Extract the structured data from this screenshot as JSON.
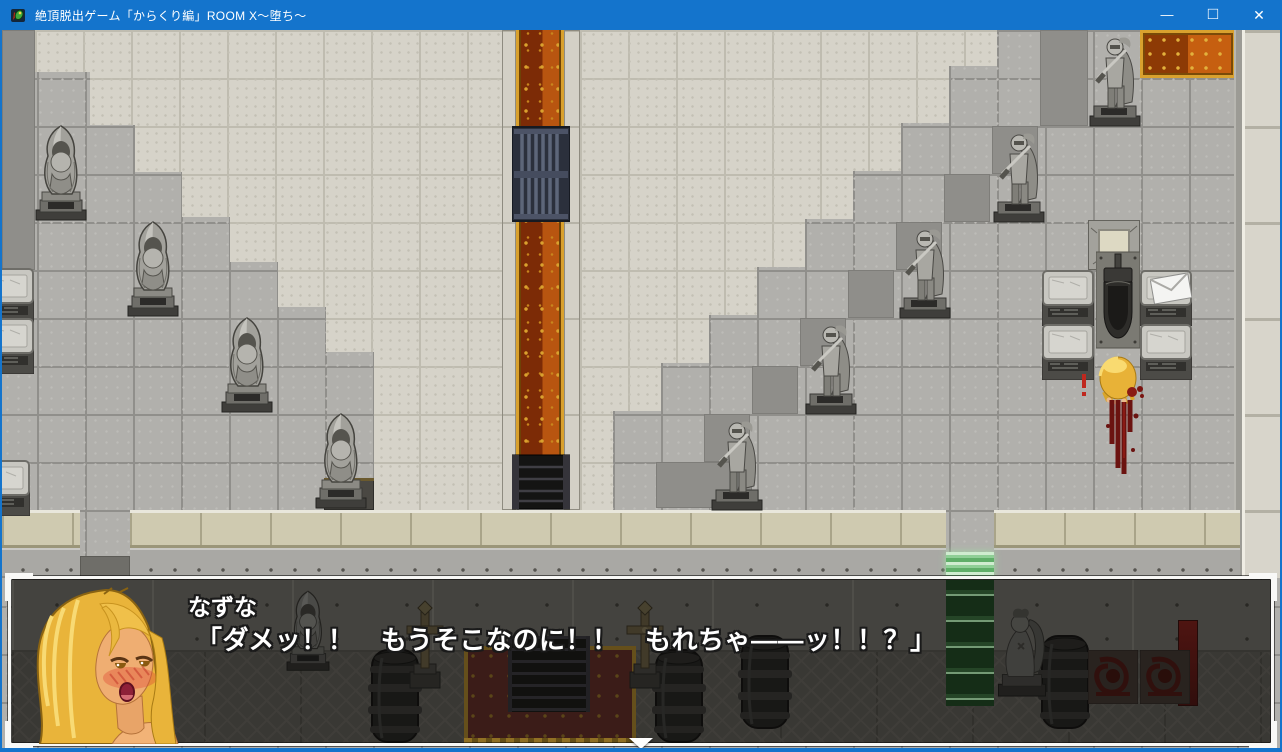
{
  "window": {
    "title": "絶頂脱出ゲーム「からくり編」ROOM X～堕ち～",
    "controls": {
      "minimize": "—",
      "maximize": "□",
      "close": "✕"
    },
    "titlebar_color": "#1474cc"
  },
  "dialogue": {
    "speaker": "なずな",
    "text": "「ダメッ！！　もうそこなのに！！　もれちゃ――ッ！！？」"
  },
  "colors": {
    "floor": "#b1b0ac",
    "platform": "#d6d3c9",
    "carpet_dark": "#7c2b06",
    "carpet_bright": "#b85510",
    "carpet_gold": "#d9a12e",
    "glow_green": "#9fd6a2",
    "blood": "#6b1310",
    "dialog_border": "#f8f8f6"
  },
  "scene": {
    "rects": [
      {
        "cls": "shadow",
        "name": "shadow-tiles",
        "x": 0,
        "y": 0,
        "w": 33,
        "h": 240
      },
      {
        "cls": "shadow",
        "name": "shadow-tiles",
        "x": 1038,
        "y": 0,
        "w": 48,
        "h": 96
      },
      {
        "cls": "shadow",
        "name": "shadow-tiles",
        "x": 990,
        "y": 96,
        "w": 46,
        "h": 48
      },
      {
        "cls": "shadow",
        "name": "shadow-tiles",
        "x": 942,
        "y": 144,
        "w": 46,
        "h": 48
      },
      {
        "cls": "shadow",
        "name": "shadow-tiles",
        "x": 894,
        "y": 192,
        "w": 46,
        "h": 48
      },
      {
        "cls": "shadow",
        "name": "shadow-tiles",
        "x": 846,
        "y": 240,
        "w": 46,
        "h": 48
      },
      {
        "cls": "shadow",
        "name": "shadow-tiles",
        "x": 798,
        "y": 288,
        "w": 46,
        "h": 48
      },
      {
        "cls": "shadow",
        "name": "shadow-tiles",
        "x": 750,
        "y": 336,
        "w": 46,
        "h": 48
      },
      {
        "cls": "shadow",
        "name": "shadow-tiles",
        "x": 702,
        "y": 384,
        "w": 46,
        "h": 48
      },
      {
        "cls": "shadow",
        "name": "shadow-tiles",
        "x": 654,
        "y": 432,
        "w": 96,
        "h": 46
      },
      {
        "cls": "cor-border",
        "name": "corridor-border",
        "x": 500,
        "y": 0,
        "w": 14,
        "h": 480
      },
      {
        "cls": "carpet-v",
        "name": "red-carpet-corridor",
        "x": 514,
        "y": 0,
        "w": 48,
        "h": 478
      },
      {
        "cls": "cor-border",
        "name": "corridor-border",
        "x": 562,
        "y": 0,
        "w": 16,
        "h": 480
      },
      {
        "cls": "carpet-h",
        "name": "red-carpet-top-right",
        "x": 1138,
        "y": 0,
        "w": 96,
        "h": 48
      },
      {
        "cls": "wallcol-edge",
        "name": "right-wall-edge",
        "x": 1232,
        "y": 0,
        "w": 8,
        "h": 548
      },
      {
        "cls": "wallcol",
        "name": "right-wall-column",
        "x": 1240,
        "y": 0,
        "w": 42,
        "h": 548
      },
      {
        "cls": "ledge",
        "name": "bottom-wall-ledge",
        "x": 0,
        "y": 480,
        "w": 78,
        "h": 38
      },
      {
        "cls": "ledge",
        "name": "bottom-wall-ledge",
        "x": 128,
        "y": 480,
        "w": 816,
        "h": 38
      },
      {
        "cls": "ledge",
        "name": "bottom-wall-ledge",
        "x": 992,
        "y": 480,
        "w": 246,
        "h": 38
      },
      {
        "cls": "wallface",
        "name": "bottom-wall-face",
        "x": 0,
        "y": 518,
        "w": 78,
        "h": 30
      },
      {
        "cls": "wallface",
        "name": "bottom-wall-face",
        "x": 128,
        "y": 518,
        "w": 816,
        "h": 30
      },
      {
        "cls": "wallface",
        "name": "bottom-wall-face",
        "x": 992,
        "y": 518,
        "w": 246,
        "h": 30
      },
      {
        "cls": "doorway",
        "name": "doorway-left",
        "x": 78,
        "y": 526,
        "w": 50,
        "h": 22
      },
      {
        "cls": "greendoor",
        "name": "glowing-green-door",
        "x": 944,
        "y": 522,
        "w": 48,
        "h": 26
      },
      {
        "cls": "darkblock",
        "name": "altar-top",
        "x": 322,
        "y": 448,
        "w": 50,
        "h": 32
      },
      {
        "cls": "metalband",
        "name": "metal-wall-band",
        "layer": "dim",
        "x": 10,
        "y": 550,
        "w": 1262,
        "h": 72
      },
      {
        "cls": "green-glow",
        "name": "green-glow-column",
        "layer": "dim",
        "x": 944,
        "y": 550,
        "w": 48,
        "h": 126
      },
      {
        "cls": "carpet-dim",
        "name": "lower-hall-carpet",
        "layer": "dim",
        "x": 462,
        "y": 616,
        "w": 172,
        "h": 98
      },
      {
        "cls": "stairwell",
        "name": "stairwell-down",
        "layer": "dim",
        "x": 506,
        "y": 606,
        "w": 82,
        "h": 76
      },
      {
        "cls": "banner",
        "name": "red-banner",
        "layer": "dim",
        "x": 1176,
        "y": 590,
        "w": 20,
        "h": 86
      },
      {
        "cls": "goldstrip",
        "name": "carpet-gold-trim",
        "layer": "dim",
        "x": 462,
        "y": 708,
        "w": 172,
        "h": 6
      }
    ],
    "objects": [
      {
        "sym": "monk",
        "name": "monk-statue",
        "x": 28,
        "y": 92,
        "w": 62,
        "h": 100
      },
      {
        "sym": "monk",
        "name": "monk-statue",
        "x": 120,
        "y": 188,
        "w": 62,
        "h": 100
      },
      {
        "sym": "monk",
        "name": "monk-statue",
        "x": 214,
        "y": 284,
        "w": 62,
        "h": 100
      },
      {
        "sym": "monk",
        "name": "monk-statue",
        "x": 308,
        "y": 380,
        "w": 62,
        "h": 100
      },
      {
        "sym": "knight",
        "name": "knight-statue",
        "x": 1084,
        "y": 0,
        "w": 58,
        "h": 98
      },
      {
        "sym": "knight",
        "name": "knight-statue",
        "x": 988,
        "y": 96,
        "w": 58,
        "h": 98
      },
      {
        "sym": "knight",
        "name": "knight-statue",
        "x": 894,
        "y": 192,
        "w": 58,
        "h": 98
      },
      {
        "sym": "knight",
        "name": "knight-statue",
        "x": 800,
        "y": 288,
        "w": 58,
        "h": 98
      },
      {
        "sym": "knight",
        "name": "knight-statue",
        "x": 706,
        "y": 384,
        "w": 58,
        "h": 98
      },
      {
        "sym": "pedestal",
        "name": "stone-pedestal",
        "x": -20,
        "y": 238,
        "w": 52,
        "h": 56
      },
      {
        "sym": "pedestal",
        "name": "stone-pedestal",
        "x": -20,
        "y": 288,
        "w": 52,
        "h": 56
      },
      {
        "sym": "pedestal",
        "name": "stone-pedestal",
        "x": -24,
        "y": 430,
        "w": 52,
        "h": 56
      },
      {
        "sym": "pedestal",
        "name": "stone-pedestal",
        "x": 1040,
        "y": 240,
        "w": 52,
        "h": 56
      },
      {
        "sym": "pedestal",
        "name": "stone-pedestal",
        "x": 1138,
        "y": 240,
        "w": 52,
        "h": 56
      },
      {
        "sym": "pedestal",
        "name": "stone-pedestal",
        "x": 1040,
        "y": 294,
        "w": 52,
        "h": 56
      },
      {
        "sym": "pedestal",
        "name": "stone-pedestal",
        "x": 1138,
        "y": 294,
        "w": 52,
        "h": 56
      },
      {
        "sym": "hatch",
        "name": "floor-hatch",
        "x": 1086,
        "y": 190,
        "w": 52,
        "h": 50
      },
      {
        "sym": "toilet",
        "name": "toilet",
        "x": 1094,
        "y": 216,
        "w": 44,
        "h": 106
      },
      {
        "sym": "grate",
        "name": "metal-grate",
        "x": 510,
        "y": 96,
        "w": 58,
        "h": 96
      },
      {
        "sym": "stairsdown",
        "name": "dark-stairs",
        "x": 510,
        "y": 424,
        "w": 58,
        "h": 56
      },
      {
        "sym": "envelope",
        "name": "envelope-item",
        "x": 1148,
        "y": 242,
        "w": 42,
        "h": 32
      },
      {
        "sym": "nazuna",
        "name": "player-character-nazuna",
        "x": 1092,
        "y": 324,
        "w": 48,
        "h": 54
      },
      {
        "sym": "bloodtrail",
        "name": "blood-trail",
        "x": 1098,
        "y": 368,
        "w": 44,
        "h": 78
      },
      {
        "sym": "bloodsplat",
        "name": "blood-splatter",
        "x": 1122,
        "y": 352,
        "w": 24,
        "h": 20
      },
      {
        "sym": "bloodmark",
        "name": "red-exclamation-mark",
        "x": 1076,
        "y": 344,
        "w": 12,
        "h": 24
      },
      {
        "sym": "barrel",
        "name": "barrel",
        "layer": "dim",
        "x": 52,
        "y": 608,
        "w": 54,
        "h": 96
      },
      {
        "sym": "barrel",
        "name": "barrel",
        "layer": "dim",
        "x": 366,
        "y": 618,
        "w": 54,
        "h": 96
      },
      {
        "sym": "barrel",
        "name": "barrel",
        "layer": "dim",
        "x": 650,
        "y": 618,
        "w": 54,
        "h": 96
      },
      {
        "sym": "barrel",
        "name": "barrel",
        "layer": "dim",
        "x": 736,
        "y": 604,
        "w": 54,
        "h": 96
      },
      {
        "sym": "barrel",
        "name": "barrel",
        "layer": "dim",
        "x": 1036,
        "y": 604,
        "w": 54,
        "h": 96
      },
      {
        "sym": "cross",
        "name": "cross-marker",
        "layer": "dim",
        "x": 396,
        "y": 568,
        "w": 54,
        "h": 92
      },
      {
        "sym": "cross",
        "name": "cross-marker",
        "layer": "dim",
        "x": 616,
        "y": 568,
        "w": 54,
        "h": 92
      },
      {
        "sym": "angel",
        "name": "angel-statue",
        "layer": "dim",
        "x": 988,
        "y": 572,
        "w": 64,
        "h": 96
      },
      {
        "sym": "monk",
        "name": "monk-statue-dim",
        "layer": "dim",
        "x": 278,
        "y": 558,
        "w": 56,
        "h": 84
      },
      {
        "sym": "bloodpanel",
        "name": "bloodstained-panel",
        "layer": "dim",
        "x": 1086,
        "y": 620,
        "w": 50,
        "h": 54
      },
      {
        "sym": "bloodpanel",
        "name": "bloodstained-panel",
        "layer": "dim",
        "x": 1138,
        "y": 620,
        "w": 50,
        "h": 54
      }
    ]
  }
}
